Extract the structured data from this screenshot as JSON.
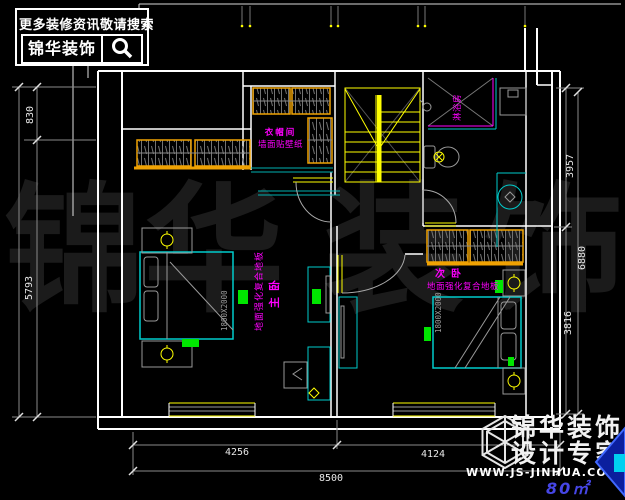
{
  "colors": {
    "background": "#000000",
    "wall": "#ffffff",
    "furniture_cyan": "#00cccc",
    "wardrobe_orange": "#f0a202",
    "stair_yellow": "#ffff00",
    "label_magenta": "#ff00ff",
    "accent_green": "#00e600",
    "dim_gray": "#8a8a8a",
    "area_blue": "#4646e6"
  },
  "header": {
    "tagline": "更多装修资讯敬请搜索",
    "brand": "锦华装饰",
    "search_icon": "magnifier"
  },
  "watermark": {
    "c1": "锦",
    "c2": "华",
    "c3": "装",
    "c4": "饰"
  },
  "rooms": {
    "master": {
      "name": "主卧",
      "finish": "地面强化复合地板",
      "bed_size": "1800X2000"
    },
    "second": {
      "name": "次卧",
      "finish": "地面强化复合地板",
      "bed_size": "1800X2000"
    },
    "cloak": {
      "name": "衣帽间",
      "finish": "墙面贴壁纸"
    },
    "shower": {
      "name": "淋浴房"
    }
  },
  "dims": {
    "bottom_left": "4256",
    "bottom_right": "4124",
    "bottom_total": "8500",
    "left_top": "830",
    "left_main": "5793",
    "right_top": "3957",
    "right_total": "6880",
    "right_bottom": "3816"
  },
  "footer": {
    "brand_line1": "锦华装饰",
    "brand_line2": "设计专家",
    "website": "WWW.JS-JINHUA.COM",
    "area": "80㎡"
  }
}
